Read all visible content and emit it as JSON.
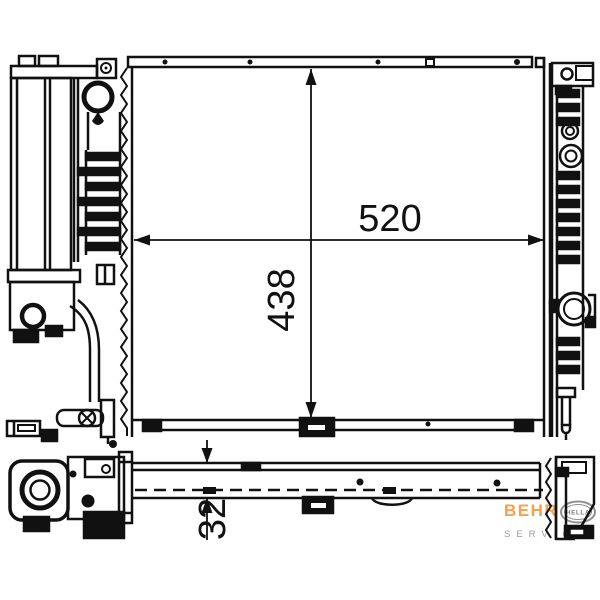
{
  "figure": {
    "views": [
      "radiator-front-view",
      "radiator-bottom-view"
    ],
    "line_color": "#111111",
    "background": "#ffffff"
  },
  "dimensions": {
    "width": {
      "label": "520"
    },
    "height": {
      "label": "438"
    },
    "thickness": {
      "label": "32"
    }
  },
  "logo": {
    "brand": "BEHR",
    "oval_text": "HELLA",
    "sub_text": "SERVICE",
    "brand_color": "#F5A04B",
    "gray_color": "#9A9A9A",
    "oval_stroke": "#8F8F8F"
  }
}
